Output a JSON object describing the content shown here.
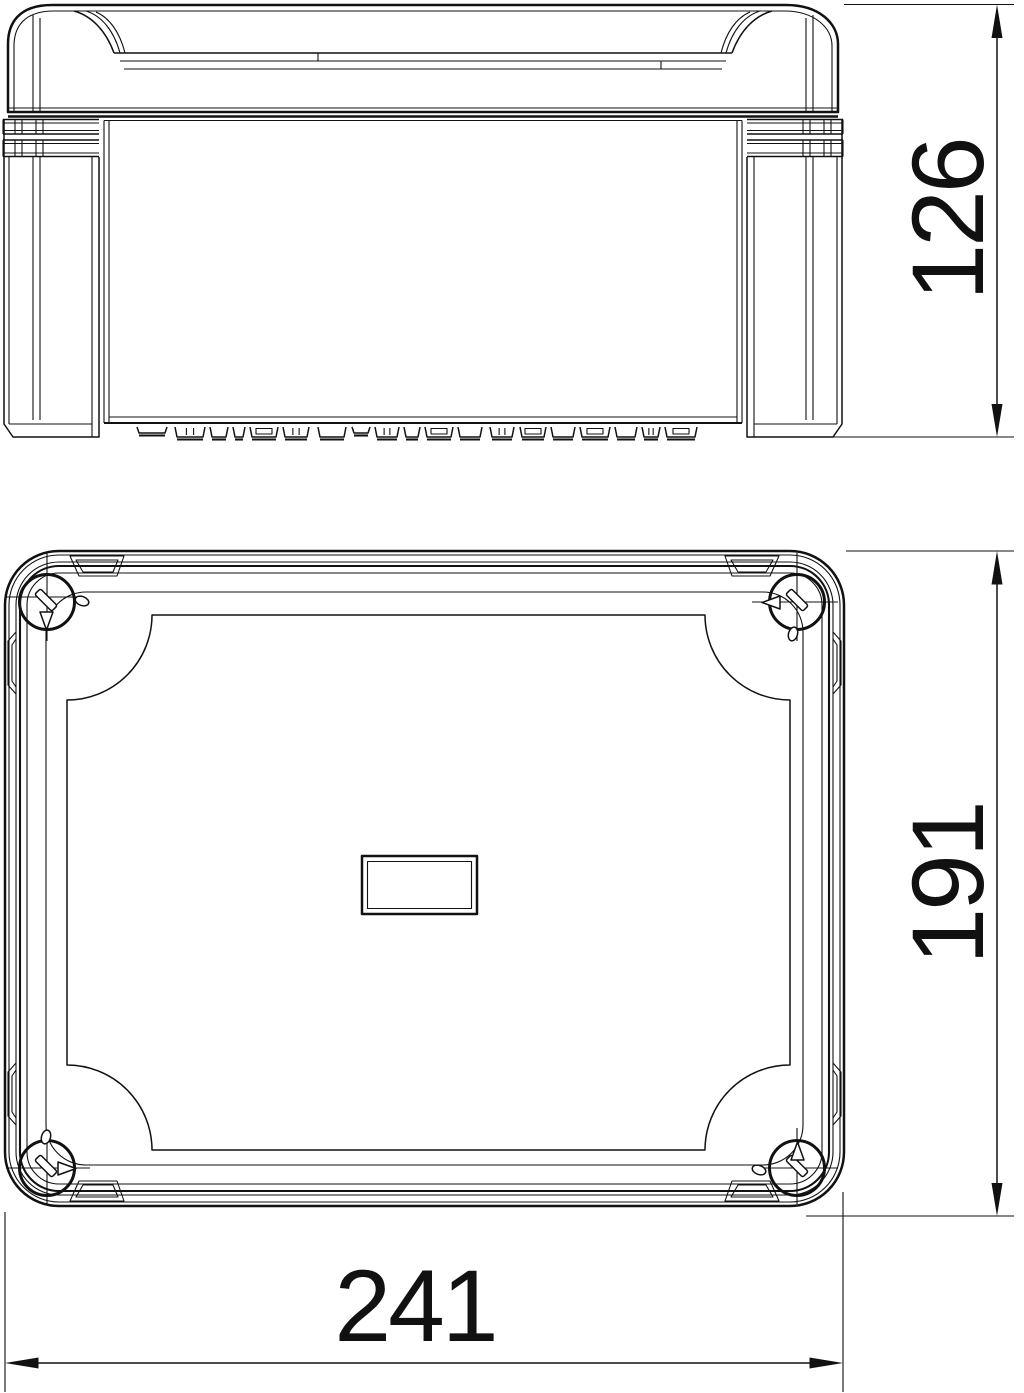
{
  "page": {
    "background": "#ffffff"
  },
  "drawing": {
    "line_color": "#111111",
    "dimensions": {
      "height": "126",
      "depth": "191",
      "width": "241"
    }
  }
}
